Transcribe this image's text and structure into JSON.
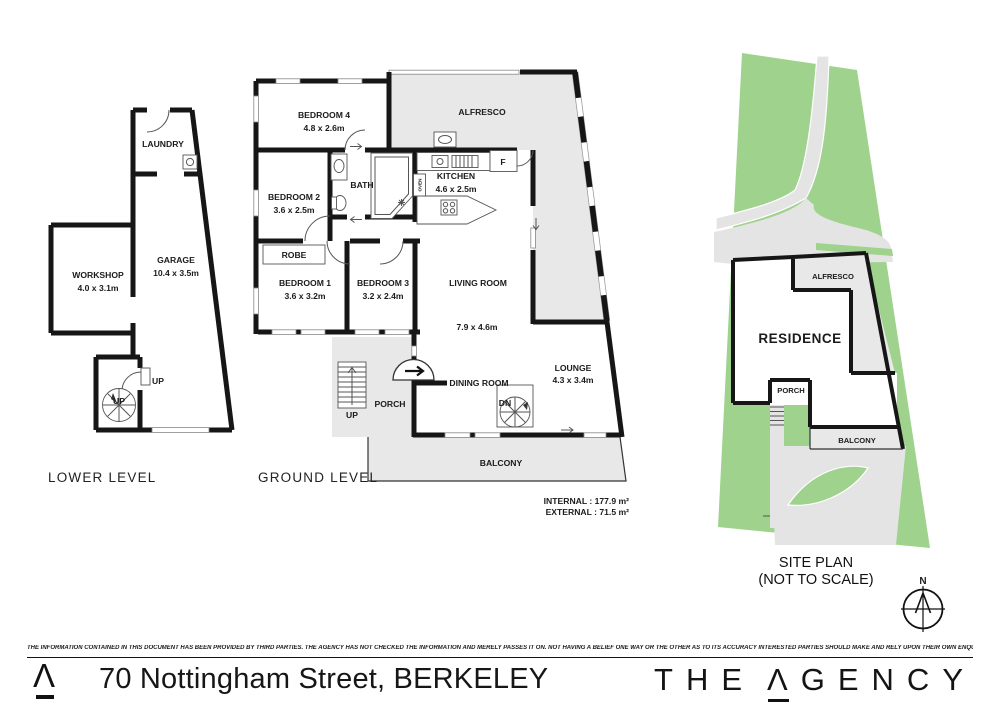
{
  "page": {
    "lower": {
      "title": "LOWER LEVEL",
      "laundry": "LAUNDRY",
      "workshop": "WORKSHOP",
      "workshop_dims": "4.0 x 3.1m",
      "garage": "GARAGE",
      "garage_dims": "10.4 x 3.5m",
      "up_door": "UP",
      "up_stair": "UP"
    },
    "ground": {
      "title": "GROUND LEVEL",
      "bedroom4": "BEDROOM 4",
      "bedroom4_dims": "4.8 x 2.6m",
      "alfresco": "ALFRESCO",
      "bedroom2": "BEDROOM 2",
      "bedroom2_dims": "3.6 x 2.5m",
      "bath": "BATH",
      "kitchen": "KITCHEN",
      "kitchen_dims": "4.6 x 2.5m",
      "fridge": "F",
      "oven": "OVEN",
      "robe": "ROBE",
      "bedroom1": "BEDROOM 1",
      "bedroom1_dims": "3.6 x 3.2m",
      "bedroom3": "BEDROOM 3",
      "bedroom3_dims": "3.2 x 2.4m",
      "living": "LIVING ROOM",
      "living_dims": "7.9 x 4.6m",
      "dining": "DINING ROOM",
      "lounge": "LOUNGE",
      "lounge_dims": "4.3 x 3.4m",
      "porch": "PORCH",
      "balcony": "BALCONY",
      "up": "UP",
      "dn": "DN",
      "internal_area": "INTERNAL : 177.9 m²",
      "external_area": "EXTERNAL : 71.5 m²"
    },
    "site": {
      "title1": "SITE PLAN",
      "title2": "(NOT TO SCALE)",
      "residence": "RESIDENCE",
      "alfresco": "ALFRESCO",
      "porch": "PORCH",
      "balcony": "BALCONY",
      "north": "N"
    },
    "footer": {
      "disclaimer": "THE INFORMATION CONTAINED IN THIS DOCUMENT HAS BEEN PROVIDED BY THIRD PARTIES. THE AGENCY HAS NOT CHECKED THE INFORMATION AND MERELY PASSES IT ON. NOT HAVING A BELIEF ONE WAY OR  THE OTHER AS TO ITS ACCURACY   INTERESTED PARTIES SHOULD MAKE AND RELY UPON THEIR OWN ENQUIRIES.",
      "address": "70 Nottingham Street, BERKELEY",
      "brand_the": "THE",
      "brand_a": "Λ",
      "brand_rest": "GENCY"
    },
    "colors": {
      "site_green": "#9fd28c",
      "outdoor_gray": "#e7e8e7",
      "wall_black": "#161616"
    }
  }
}
